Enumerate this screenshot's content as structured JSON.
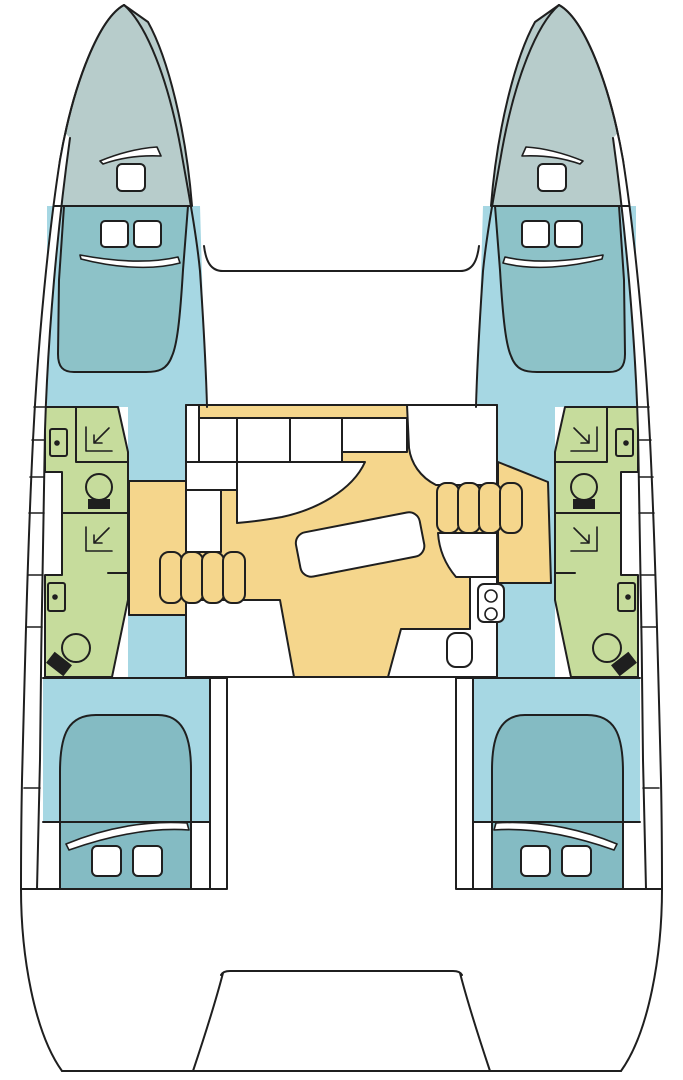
{
  "canvas": {
    "width": 683,
    "height": 1080
  },
  "colors": {
    "background": "#ffffff",
    "line": "#1f1f1f",
    "bow_deck": "#b7cccb",
    "berth_forward": "#8dc2c8",
    "berth_aft": "#84bbc3",
    "cabin_floor": "#a6d7e3",
    "wet_room": "#c6dc9c",
    "saloon_floor": "#f5d68c",
    "furniture": "#ffffff",
    "fixture_dark": "#1f1f1f"
  },
  "plan": {
    "type": "catamaran-deck-plan",
    "symmetry": "port-starboard mirrored layout",
    "hulls": [
      {
        "side": "port",
        "rooms": [
          "bow-deck",
          "forward-cabin-berth",
          "forward-head",
          "forward-shower-room",
          "aft-shower-room",
          "aft-head",
          "aft-cabin-berth"
        ],
        "fixtures": [
          "deck-hatch",
          "cabin-hatch",
          "cabin-hatch",
          "wash-basin",
          "shower-drain",
          "toilet",
          "shower-drain",
          "wash-basin",
          "toilet",
          "companionway-landing",
          "bed-hatch",
          "bed-hatch"
        ]
      },
      {
        "side": "starboard",
        "rooms": [
          "bow-deck",
          "forward-cabin-berth",
          "forward-head",
          "forward-shower-room",
          "aft-shower-room",
          "aft-head",
          "aft-cabin-berth"
        ],
        "fixtures": [
          "deck-hatch",
          "cabin-hatch",
          "cabin-hatch",
          "wash-basin",
          "shower-drain",
          "toilet",
          "shower-drain",
          "wash-basin",
          "toilet",
          "companionway-landing",
          "bed-hatch",
          "bed-hatch"
        ]
      }
    ],
    "center": {
      "rooms": [
        "trampoline-foredeck",
        "bridge-deck",
        "saloon",
        "cockpit",
        "transom-platform"
      ],
      "saloon_fixtures": [
        "galley-counter-cells",
        "port-settee",
        "starboard-settee",
        "dinette-table",
        "companionway-steps-port",
        "companionway-steps-starboard",
        "sink-stove-unit",
        "galley-box",
        "aft-counter-port",
        "aft-counter-starboard"
      ]
    },
    "counts": {
      "cabins": 4,
      "heads": 4,
      "showers": 4,
      "step-flights": 2,
      "deck-hatches": 10
    }
  }
}
